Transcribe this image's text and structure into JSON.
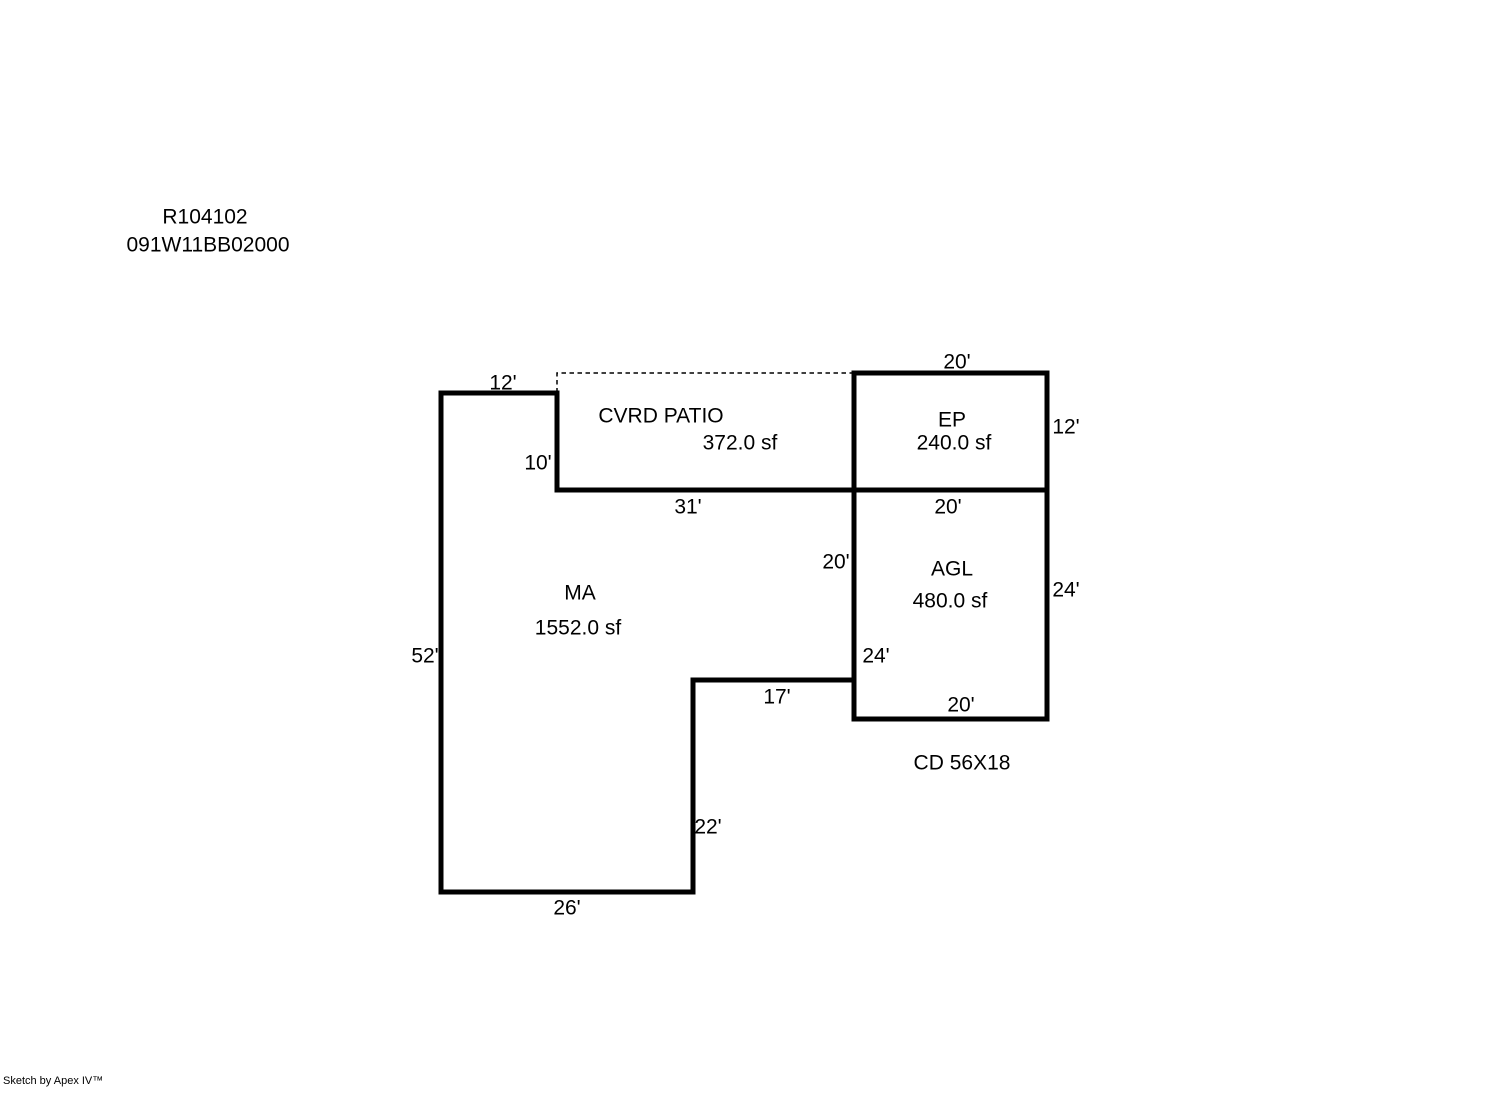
{
  "header": {
    "record_id": "R104102",
    "parcel_id": "091W11BB02000"
  },
  "sketch": {
    "areas": {
      "cvrd_patio": {
        "name": "CVRD PATIO",
        "size": "372.0 sf"
      },
      "ep": {
        "name": "EP",
        "size": "240.0 sf"
      },
      "ma": {
        "name": "MA",
        "size": "1552.0 sf"
      },
      "agl": {
        "name": "AGL",
        "size": "480.0 sf"
      },
      "cd": {
        "name": "CD 56X18"
      }
    },
    "dimensions": {
      "ma_top": "12'",
      "ma_notch_left": "10'",
      "patio_bottom": "31'",
      "ep_top": "20'",
      "ep_right": "12'",
      "agl_top": "20'",
      "ma_right": "20'",
      "agl_right": "24'",
      "agl_left": "24'",
      "ma_step_horizontal": "17'",
      "agl_bottom": "20'",
      "ma_left": "52'",
      "ma_step_vertical": "22'",
      "ma_bottom": "26'"
    },
    "colors": {
      "ink": "#000000",
      "background": "#ffffff"
    }
  },
  "footer": {
    "credit": "Sketch by Apex IV™"
  }
}
